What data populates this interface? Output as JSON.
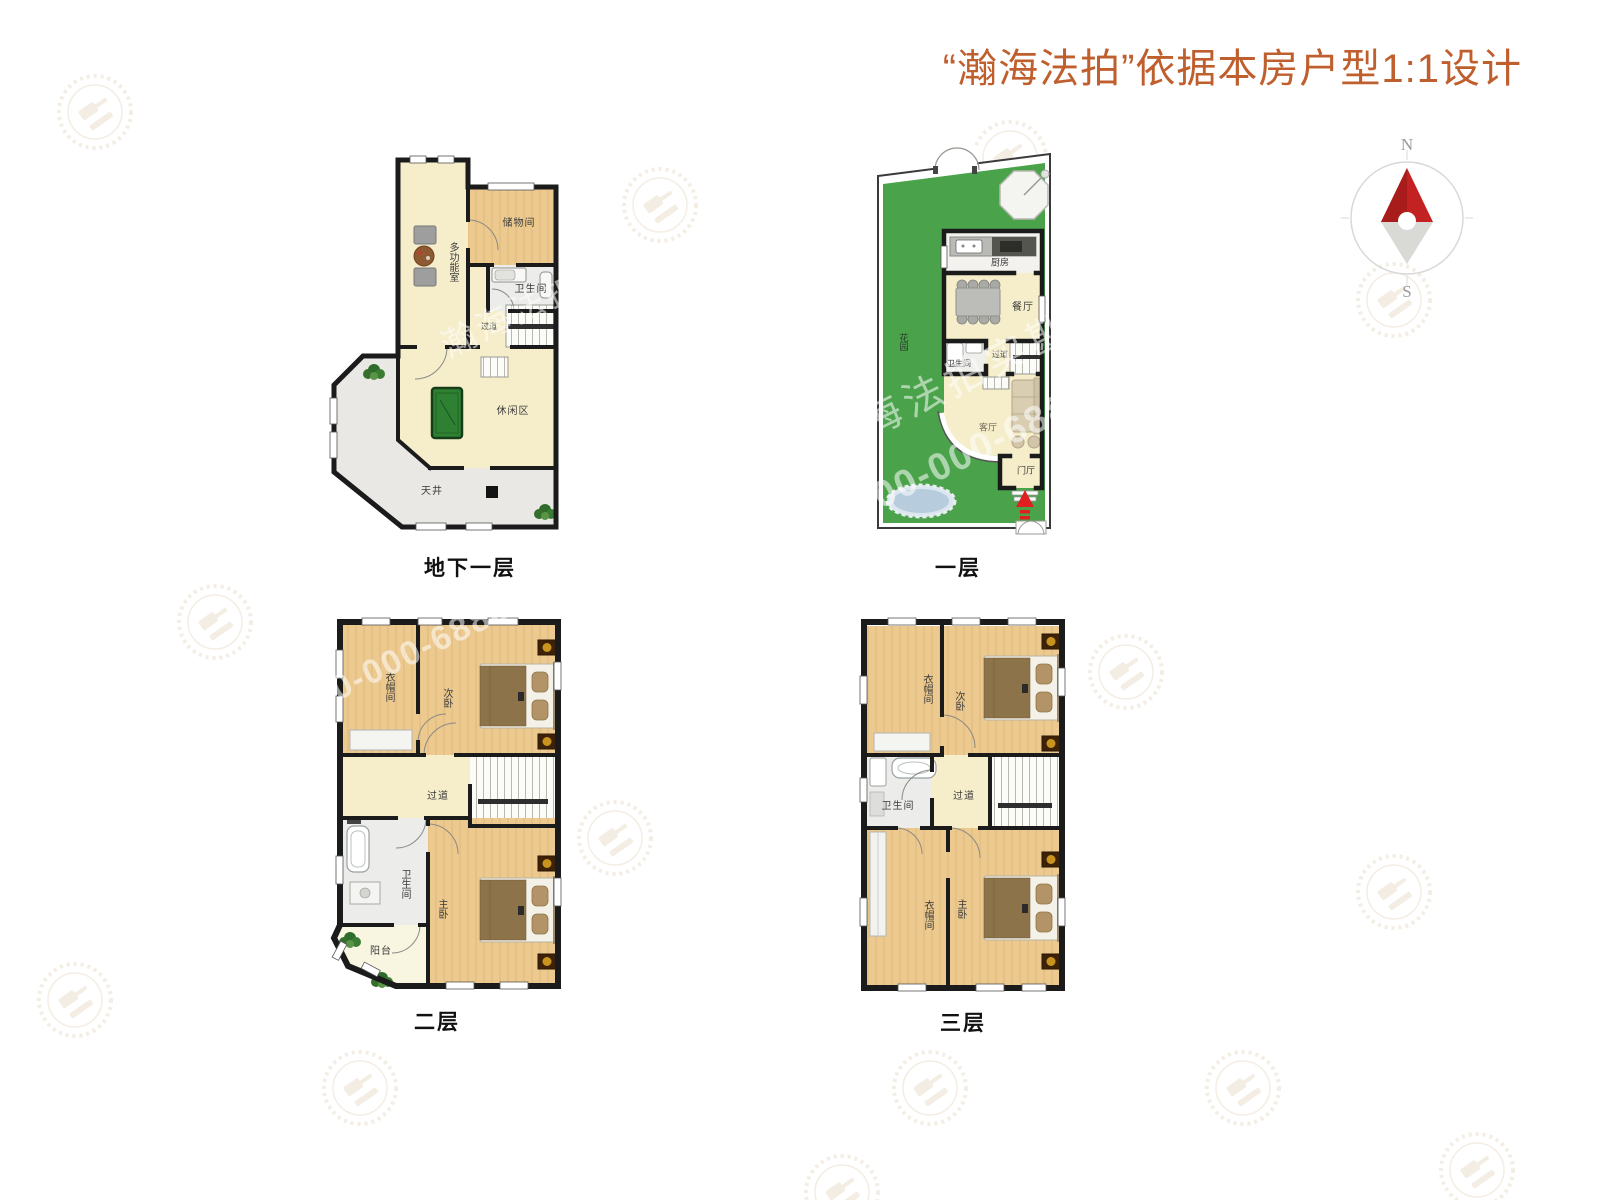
{
  "title": "“瀚海法拍”依据本房户型1:1设计",
  "compass": {
    "north": "N",
    "south": "S"
  },
  "watermarks": {
    "brand": "瀚海法拍实勘",
    "phone": "400-000-6888"
  },
  "colors": {
    "title_accent": "#c05f2e",
    "wall": "#1b1b1b",
    "floor_cream": "#f6eecb",
    "floor_wood": "#ecc98f",
    "garden_green": "#4aa34a",
    "entry_arrow": "#e02020"
  },
  "floors": [
    {
      "caption": "地下一层",
      "rooms": {
        "multi": "多功能室",
        "storage": "储物间",
        "bath": "卫生间",
        "hall": "过道",
        "leisure": "休闲区",
        "courtyard": "天井"
      }
    },
    {
      "caption": "一层",
      "rooms": {
        "garden": "花园",
        "kitchen": "厨房",
        "dining": "餐厅",
        "bath": "卫生间",
        "hall": "过道",
        "living": "客厅",
        "entry": "门厅"
      }
    },
    {
      "caption": "二层",
      "rooms": {
        "cloak": "衣帽间",
        "second_bedroom": "次卧",
        "hall": "过道",
        "bath": "卫生间",
        "master_bedroom": "主卧",
        "balcony": "阳台"
      }
    },
    {
      "caption": "三层",
      "rooms": {
        "cloak": "衣帽间",
        "second_bedroom": "次卧",
        "bath": "卫生间",
        "hall": "过道",
        "cloak2": "衣帽间",
        "master_bedroom": "主卧"
      }
    }
  ]
}
